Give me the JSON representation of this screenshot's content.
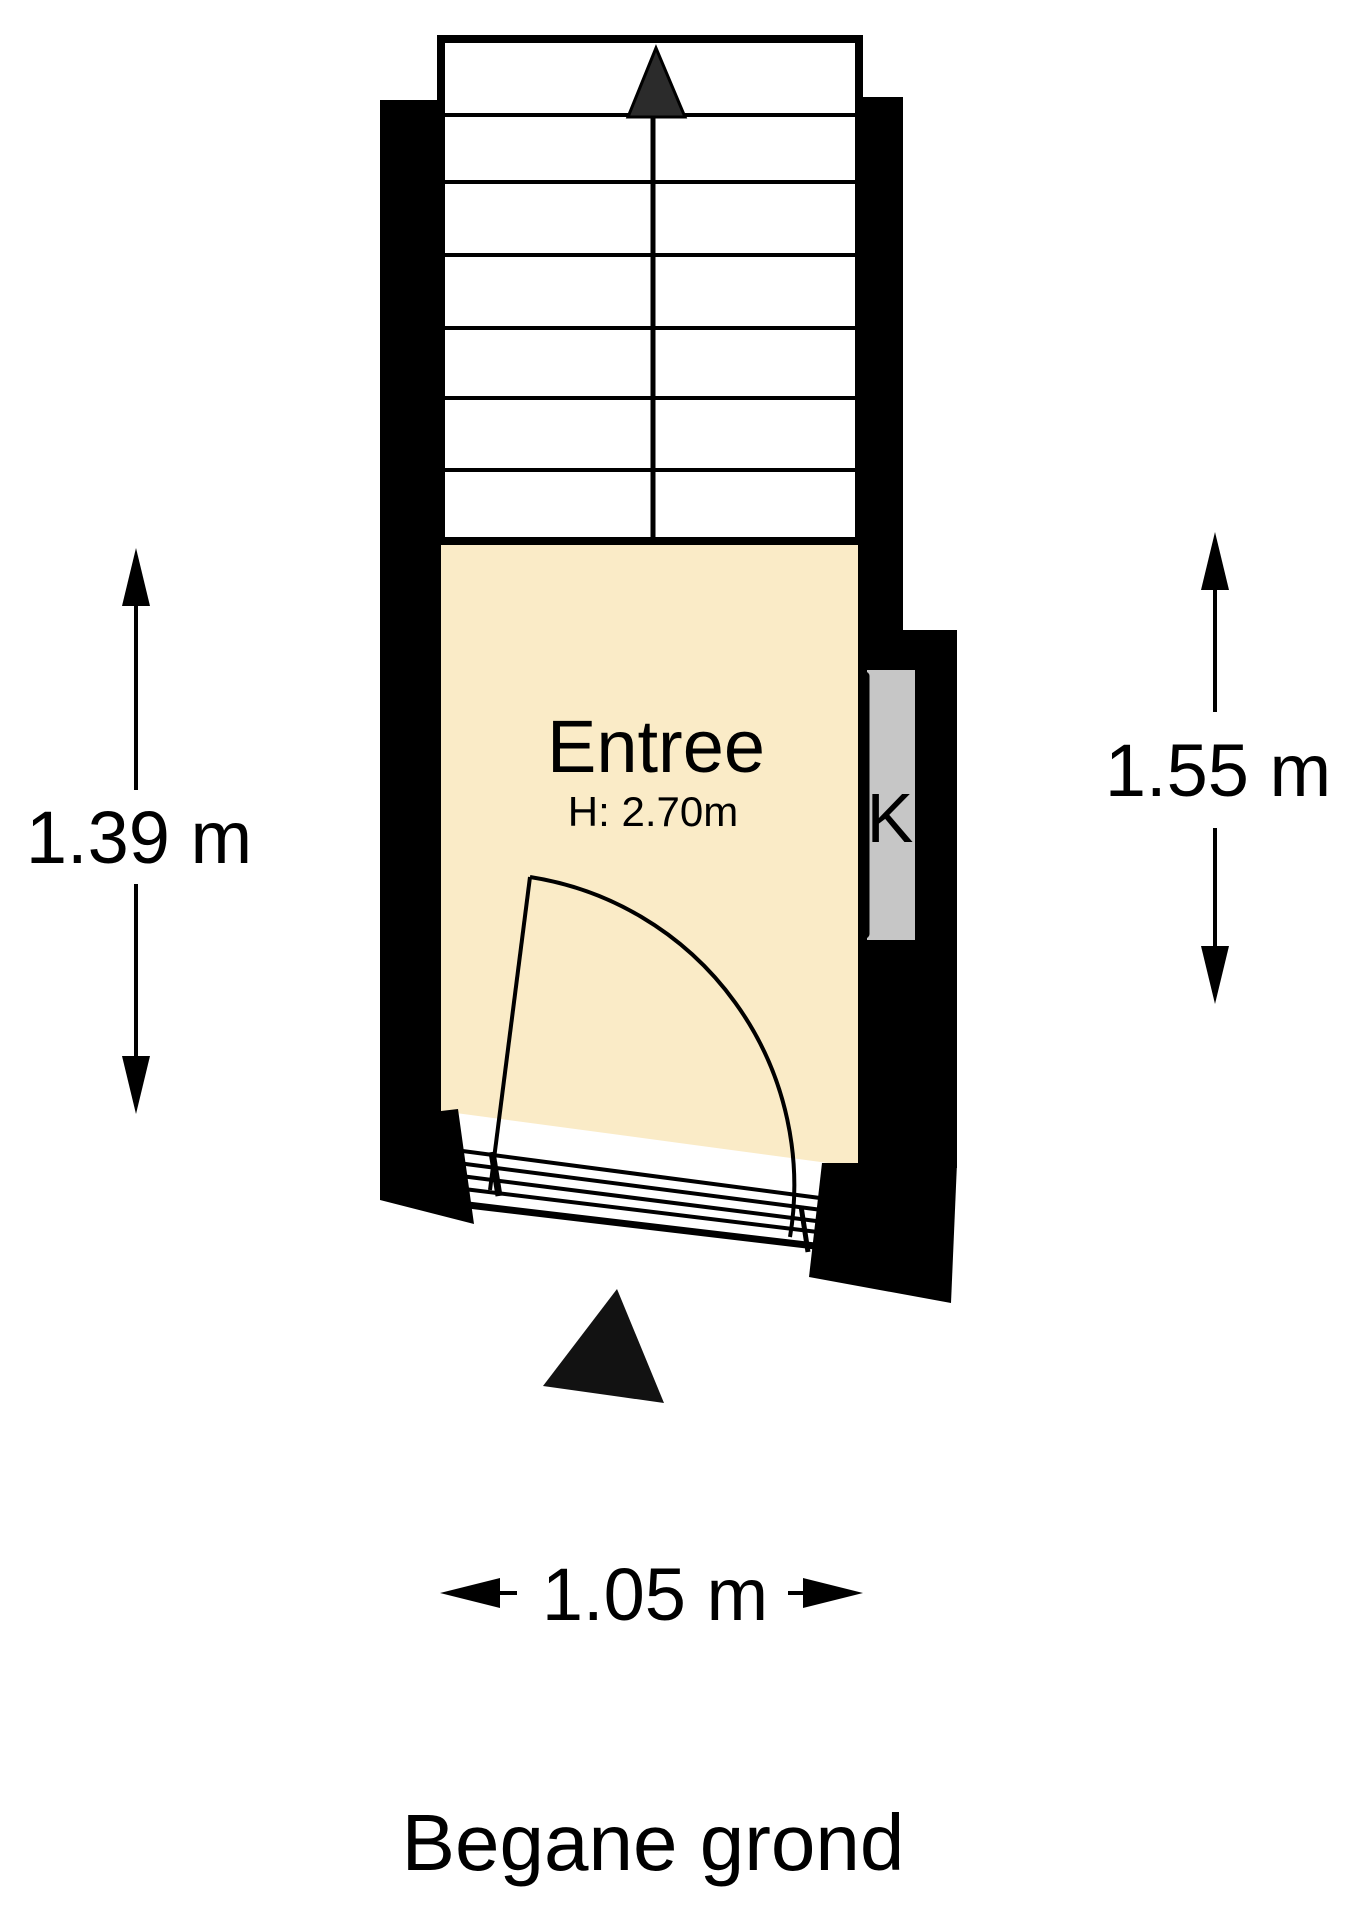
{
  "plan": {
    "title": "Begane grond",
    "room": {
      "name": "Entree",
      "height_label": "H: 2.70m"
    },
    "closet": {
      "label": "K"
    },
    "dimensions": {
      "left": {
        "label": "1.39 m"
      },
      "right": {
        "label": "1.55 m"
      },
      "bottom": {
        "label": "1.05 m"
      }
    },
    "icons": {
      "stairs_direction": "up-arrow-icon",
      "entrance_marker": "entrance-triangle-icon"
    },
    "colors": {
      "room_fill": "#FAEBC7",
      "closet_fill": "#C6C6C6",
      "wall": "#000000",
      "line": "#000000",
      "stairs_fill": "#FFFFFF",
      "stairs_arrow": "#2B2B2B",
      "entrance_arrow": "#121212"
    }
  }
}
